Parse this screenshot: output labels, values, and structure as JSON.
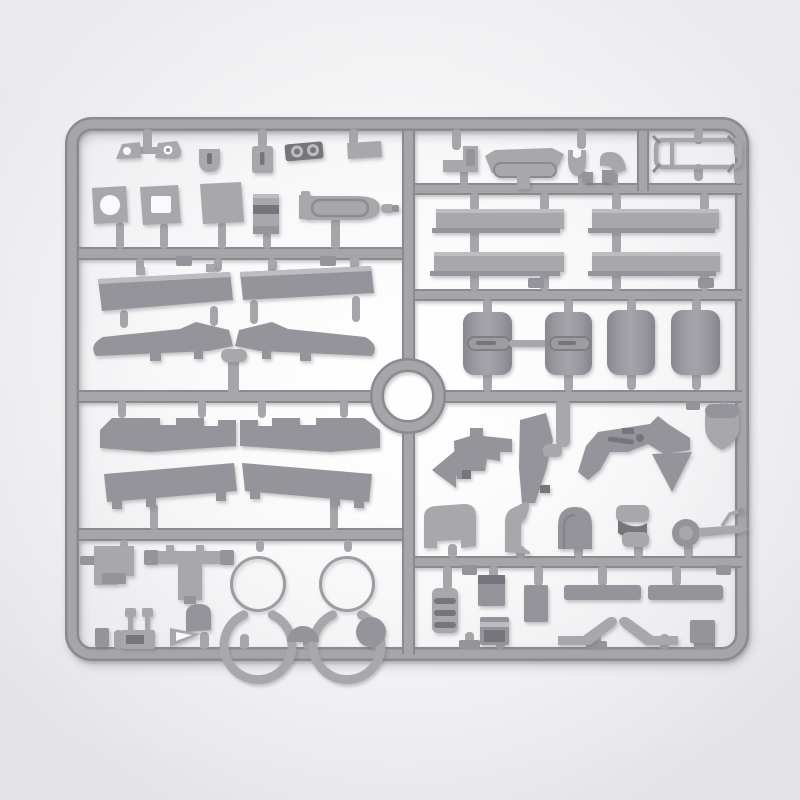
{
  "meta": {
    "kind": "photograph",
    "subject": "Unpainted gray injection-molded model kit sprue (parts frame) with aircraft and vehicle parts, photographed on a light studio background",
    "layout": "rounded rectangular sprue frame, internal runner grid, circular runner ring at center"
  },
  "colors": {
    "page_bg": "#e8e8eb",
    "page_bg_edge": "#eaeaed",
    "page_bg_low": "#e3e3e7",
    "glow": "#fafafc",
    "runner": "#a5a5aa",
    "runner_dark": "#8a8a90",
    "part": "#a7a7ac",
    "part_dark": "#94949a",
    "detail_dark": "#75757b",
    "part_light": "#bcbcc1",
    "shadow": "#70707c"
  },
  "sprue": {
    "frame": "rounded-rectangle runner frame with gate stubs",
    "center_feature": "circular-runner-ring",
    "sections": {
      "top_left_row_1": [
        "hinge-plate",
        "hinge-plate",
        "u-clamp",
        "slotted-plate",
        "twin-dial-block",
        "small-plate"
      ],
      "top_left_row_2": [
        "plate-round-hole",
        "plate-square-hole",
        "plain-plate",
        "folded-strap",
        "engine-pod",
        "pod-peg"
      ],
      "left_panels_row": [
        "long-panel",
        "long-panel"
      ],
      "wings_row": [
        "wing-half-left",
        "wing-half-right"
      ],
      "left_notched_panels_row": [
        "notched-panel",
        "notched-panel"
      ],
      "left_lower_panels_row": [
        "footed-panel",
        "footed-panel"
      ],
      "bottom_left": [
        "hatch-box",
        "t-bracket",
        "c-ring",
        "c-ring",
        "half-dome",
        "round-disc",
        "small-block",
        "twin-lever-unit",
        "scoop-with-hood"
      ],
      "top_right_row": [
        "step-bracket",
        "dashboard-panel",
        "fork-piece",
        "curved-elbow",
        "windshield-frame"
      ],
      "right_panel_rows": [
        "flat-bar",
        "flat-bar",
        "flat-bar",
        "flat-bar"
      ],
      "wheels_row": [
        "wheel-half-slotted",
        "wheel-half-slotted",
        "wheel-half",
        "wheel-half"
      ],
      "right_chassis_row": [
        "carriage-assembly",
        "angled-blade",
        "pipe-elbow",
        "carriage-assembly",
        "wedge-plate",
        "shield-teardrop"
      ],
      "right_small_parts_row": [
        "cab-box",
        "curved-bracket",
        "arched-cover",
        "folded-seat",
        "handwheel-shaft"
      ],
      "bottom_right": [
        "grooved-block",
        "small-box",
        "lidded-box",
        "small-slab",
        "flat-strip",
        "flat-strip",
        "step-runner-left",
        "step-runner-right",
        "small-plate"
      ]
    },
    "counts": {
      "wheel_halves": 4,
      "large_c_rings": 2,
      "wing_halves": 4,
      "long_flat_bars": 4
    }
  }
}
